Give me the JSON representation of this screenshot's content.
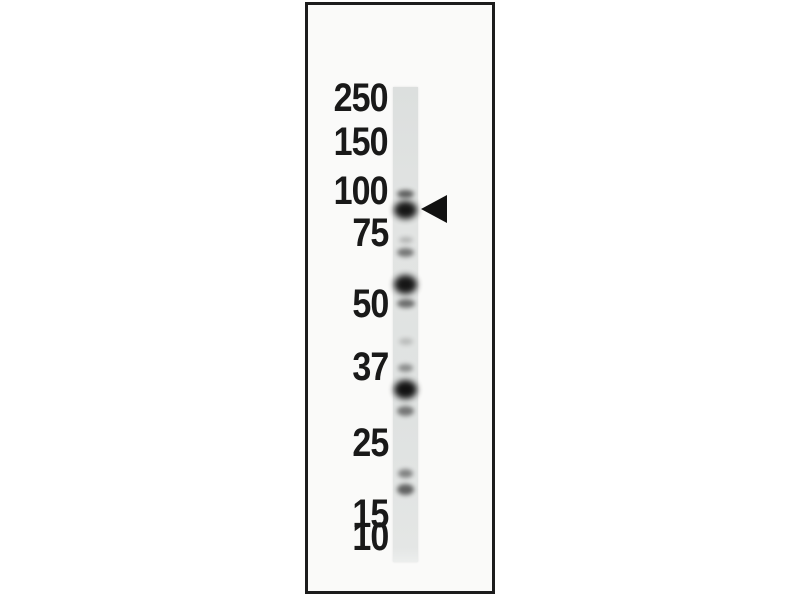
{
  "figure": {
    "page_background": "#ffffff",
    "panel": {
      "left": 305,
      "top": 2,
      "width": 190,
      "height": 592,
      "border_width": 3,
      "border_color": "#1c1c1c",
      "background": "#fafaf9"
    },
    "lane": {
      "left": 393,
      "top": 87,
      "width": 25,
      "height": 475,
      "color": "#dfe1e0"
    },
    "label_style": {
      "color": "#191919",
      "right_edge_x": 388
    },
    "markers": [
      {
        "label": "250",
        "y": 98
      },
      {
        "label": "150",
        "y": 142
      },
      {
        "label": "100",
        "y": 191
      },
      {
        "label": "75",
        "y": 233
      },
      {
        "label": "50",
        "y": 304
      },
      {
        "label": "37",
        "y": 367
      },
      {
        "label": "25",
        "y": 443
      },
      {
        "label": "15",
        "y": 514
      },
      {
        "label": "10",
        "y": 537
      }
    ],
    "bands": [
      {
        "y": 194,
        "height": 8,
        "width": 17,
        "intensity": 0.62
      },
      {
        "y": 210,
        "height": 18,
        "width": 23,
        "intensity": 0.95
      },
      {
        "y": 240,
        "height": 6,
        "width": 14,
        "intensity": 0.22
      },
      {
        "y": 252,
        "height": 9,
        "width": 17,
        "intensity": 0.5
      },
      {
        "y": 284,
        "height": 19,
        "width": 23,
        "intensity": 0.95
      },
      {
        "y": 303,
        "height": 9,
        "width": 18,
        "intensity": 0.55
      },
      {
        "y": 341,
        "height": 7,
        "width": 14,
        "intensity": 0.18
      },
      {
        "y": 368,
        "height": 8,
        "width": 15,
        "intensity": 0.4
      },
      {
        "y": 389,
        "height": 19,
        "width": 23,
        "intensity": 0.97
      },
      {
        "y": 411,
        "height": 10,
        "width": 17,
        "intensity": 0.5
      },
      {
        "y": 473,
        "height": 9,
        "width": 15,
        "intensity": 0.45
      },
      {
        "y": 489,
        "height": 11,
        "width": 17,
        "intensity": 0.6
      }
    ],
    "band_color": "#0c0c0c",
    "arrowhead": {
      "tip_x": 421,
      "center_y": 209,
      "width": 26,
      "height": 28,
      "color": "#111111",
      "points_to_band_y": 210
    }
  }
}
